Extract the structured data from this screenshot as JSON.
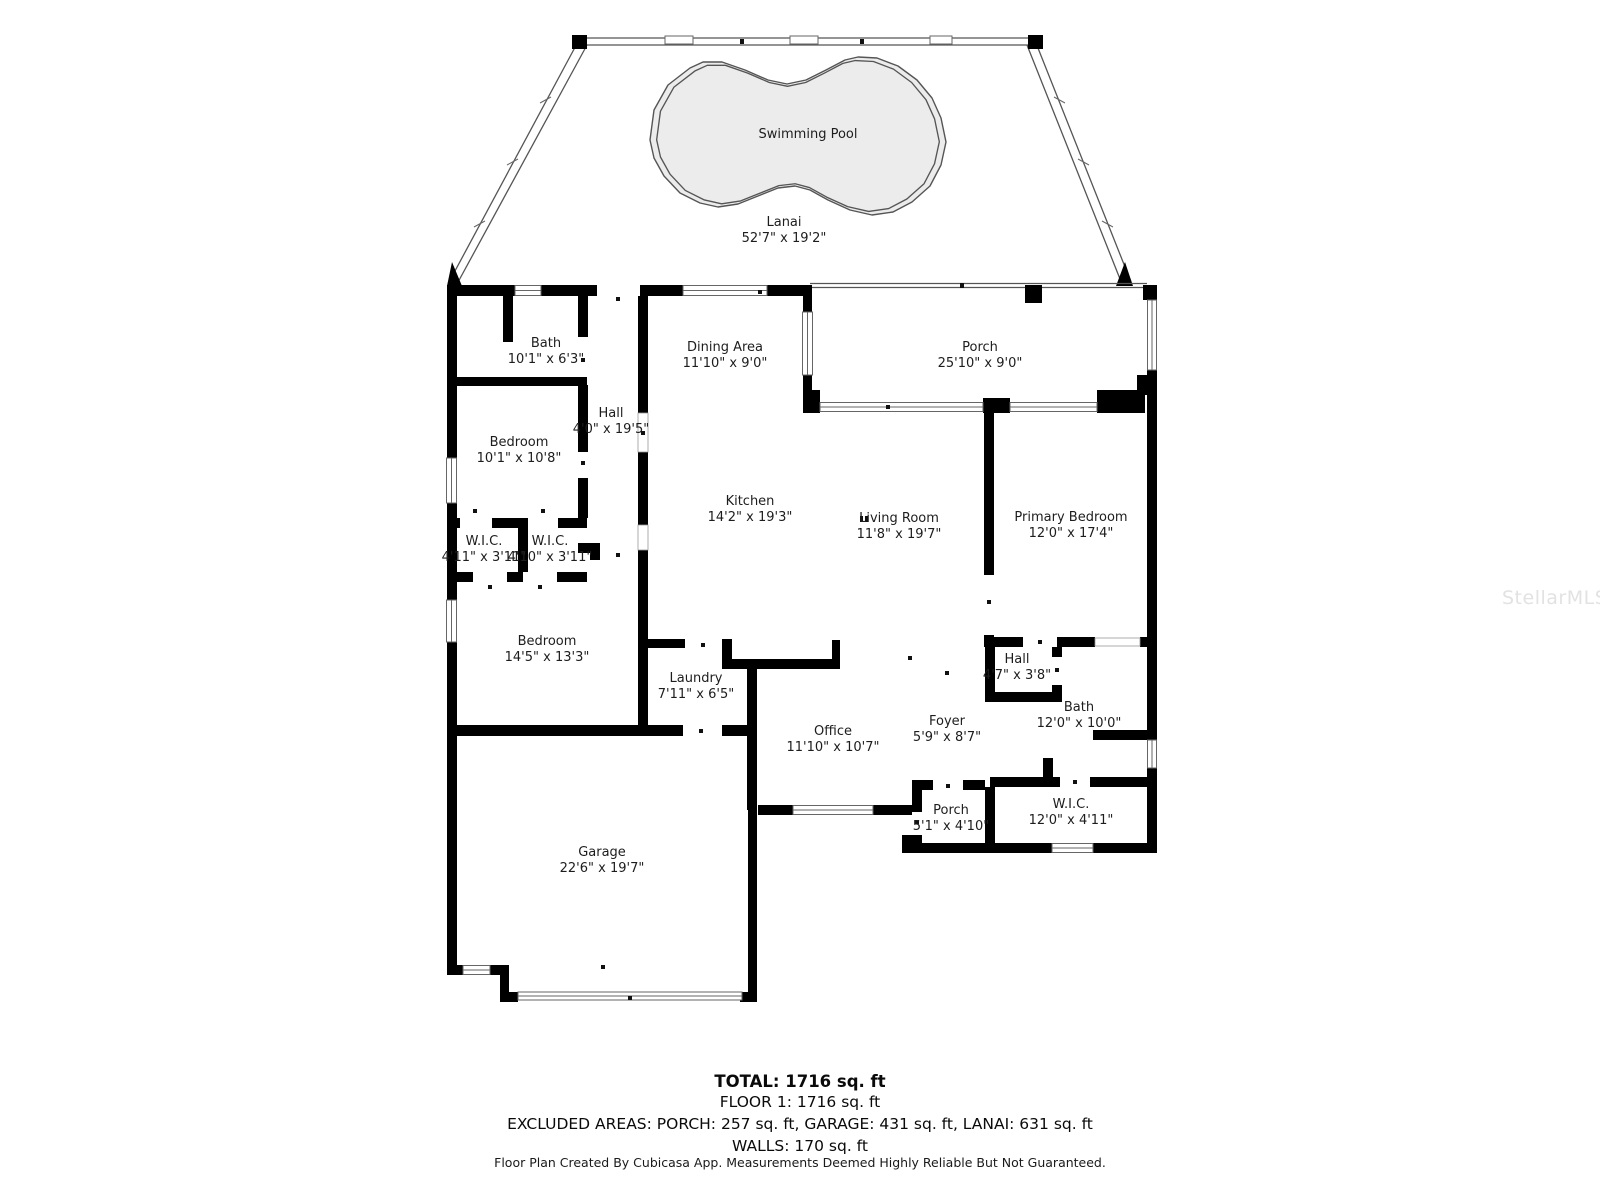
{
  "watermark": "StellarMLS",
  "rooms": [
    {
      "name": "Swimming Pool",
      "dims": "",
      "x": 808,
      "y": 134
    },
    {
      "name": "Lanai",
      "dims": "52'7\" x 19'2\"",
      "x": 784,
      "y": 222
    },
    {
      "name": "Bath",
      "dims": "10'1\" x 6'3\"",
      "x": 546,
      "y": 343
    },
    {
      "name": "Dining Area",
      "dims": "11'10\" x 9'0\"",
      "x": 725,
      "y": 347
    },
    {
      "name": "Porch",
      "dims": "25'10\" x 9'0\"",
      "x": 980,
      "y": 347
    },
    {
      "name": "Hall",
      "dims": "4'0\" x 19'5\"",
      "x": 611,
      "y": 413
    },
    {
      "name": "Bedroom",
      "dims": "10'1\" x 10'8\"",
      "x": 519,
      "y": 442
    },
    {
      "name": "Kitchen",
      "dims": "14'2\" x 19'3\"",
      "x": 750,
      "y": 501
    },
    {
      "name": "Living Room",
      "dims": "11'8\" x 19'7\"",
      "x": 899,
      "y": 518
    },
    {
      "name": "Primary Bedroom",
      "dims": "12'0\" x 17'4\"",
      "x": 1071,
      "y": 517
    },
    {
      "name": "W.I.C.",
      "dims": "4'11\" x 3'11\"",
      "x": 484,
      "y": 541
    },
    {
      "name": "W.I.C.",
      "dims": "4'10\" x 3'11\"",
      "x": 550,
      "y": 541
    },
    {
      "name": "Bedroom",
      "dims": "14'5\" x 13'3\"",
      "x": 547,
      "y": 641
    },
    {
      "name": "Laundry",
      "dims": "7'11\" x 6'5\"",
      "x": 696,
      "y": 678
    },
    {
      "name": "Hall",
      "dims": "4'7\" x 3'8\"",
      "x": 1017,
      "y": 659
    },
    {
      "name": "Bath",
      "dims": "12'0\" x 10'0\"",
      "x": 1079,
      "y": 707
    },
    {
      "name": "Office",
      "dims": "11'10\" x 10'7\"",
      "x": 833,
      "y": 731
    },
    {
      "name": "Foyer",
      "dims": "5'9\" x 8'7\"",
      "x": 947,
      "y": 721
    },
    {
      "name": "Porch",
      "dims": "5'1\" x 4'10\"",
      "x": 951,
      "y": 810
    },
    {
      "name": "W.I.C.",
      "dims": "12'0\" x 4'11\"",
      "x": 1071,
      "y": 804
    },
    {
      "name": "Garage",
      "dims": "22'6\" x 19'7\"",
      "x": 602,
      "y": 852
    }
  ],
  "summary": {
    "total": "TOTAL: 1716 sq. ft",
    "floor1": "FLOOR 1: 1716 sq. ft",
    "excluded": "EXCLUDED AREAS: PORCH: 257 sq. ft, GARAGE: 431 sq. ft, LANAI: 631 sq. ft",
    "walls": "WALLS: 170 sq. ft"
  },
  "disclaimer": "Floor Plan Created By Cubicasa App. Measurements Deemed Highly Reliable But Not Guaranteed.",
  "colors": {
    "wall": "#000000",
    "pool_fill": "#ececec",
    "pool_stroke": "#555555",
    "watermark": "#e2e2e2",
    "label": "#1d1d1d"
  }
}
